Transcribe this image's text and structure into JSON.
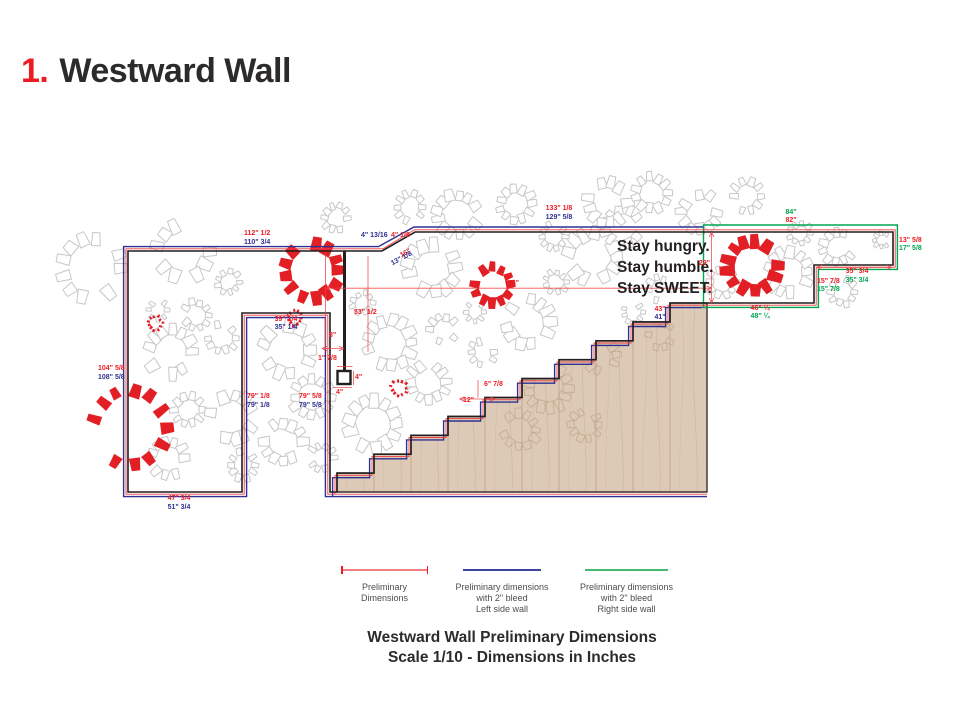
{
  "title": {
    "number": "1.",
    "text": "Westward Wall"
  },
  "quote": {
    "lines": [
      "Stay hungry.",
      "Stay humble.",
      "Stay SWEET."
    ]
  },
  "colors": {
    "red": "#ed1c24",
    "blue": "#2e3192",
    "green": "#00a551",
    "black": "#231f20",
    "legend_red_line": "#f0807f",
    "legend_blue_line": "#3d44a0",
    "legend_green_line": "#45b96f",
    "wood": "#dccab7"
  },
  "dimension_labels": [
    {
      "text": "112\" 1/2",
      "color": "red",
      "x": 244,
      "y": 230,
      "align": "left"
    },
    {
      "text": "110\" 3/4",
      "color": "blue",
      "x": 244,
      "y": 238.5,
      "align": "left"
    },
    {
      "text": "104\" 5/8",
      "color": "red",
      "x": 98,
      "y": 365,
      "align": "left"
    },
    {
      "text": "108\" 5/8",
      "color": "blue",
      "x": 98,
      "y": 373.5,
      "align": "left"
    },
    {
      "text": "47\" 3/4",
      "color": "red",
      "x": 179,
      "y": 495,
      "align": "center"
    },
    {
      "text": "51\" 3/4",
      "color": "blue",
      "x": 179,
      "y": 503.5,
      "align": "center"
    },
    {
      "text": "39\" 1/4",
      "color": "red",
      "x": 286,
      "y": 315.5,
      "align": "center"
    },
    {
      "text": "35\" 1/4",
      "color": "blue",
      "x": 286,
      "y": 324,
      "align": "center"
    },
    {
      "text": "79\" 1/8",
      "color": "red",
      "x": 247,
      "y": 393,
      "align": "left"
    },
    {
      "text": "79\" 1/8",
      "color": "blue",
      "x": 247,
      "y": 401.5,
      "align": "left"
    },
    {
      "text": "79\" 5/8",
      "color": "red",
      "x": 299,
      "y": 393,
      "align": "left"
    },
    {
      "text": "79\" 5/8",
      "color": "blue",
      "x": 299,
      "y": 401.5,
      "align": "left"
    },
    {
      "text": "8\"",
      "color": "red",
      "x": 329,
      "y": 332,
      "align": "left"
    },
    {
      "text": "53\" 1/2",
      "color": "red",
      "x": 354,
      "y": 309,
      "align": "left"
    },
    {
      "text": "4\" 13/16",
      "color": "blue",
      "x": 361,
      "y": 232,
      "align": "left"
    },
    {
      "text": "4\" 1/8",
      "color": "red",
      "x": 391,
      "y": 232,
      "align": "left"
    },
    {
      "text": "16\"",
      "color": "red",
      "x": 399,
      "y": 253,
      "align": "left",
      "rotate": -28
    },
    {
      "text": "13\" 1/8",
      "color": "blue",
      "x": 390,
      "y": 261,
      "align": "left",
      "rotate": -28
    },
    {
      "text": "133\" 1/8",
      "color": "red",
      "x": 559,
      "y": 205,
      "align": "center"
    },
    {
      "text": "129\" 5/8",
      "color": "blue",
      "x": 559,
      "y": 213.5,
      "align": "center"
    },
    {
      "text": "1\" 7/8",
      "color": "red",
      "x": 318,
      "y": 355,
      "align": "left"
    },
    {
      "text": "4\"",
      "color": "red",
      "x": 355,
      "y": 374,
      "align": "left"
    },
    {
      "text": "4\"",
      "color": "red",
      "x": 336,
      "y": 388.5,
      "align": "left"
    },
    {
      "text": "66\"",
      "color": "red",
      "x": 508,
      "y": 279.5,
      "align": "left"
    },
    {
      "text": "6\" 7/8",
      "color": "red",
      "x": 484,
      "y": 381,
      "align": "left"
    },
    {
      "text": "12\"",
      "color": "red",
      "x": 463,
      "y": 397,
      "align": "left"
    },
    {
      "text": "43\"",
      "color": "red",
      "x": 660,
      "y": 305.5,
      "align": "center"
    },
    {
      "text": "41\"",
      "color": "blue",
      "x": 660,
      "y": 314,
      "align": "center"
    },
    {
      "text": "84\"",
      "color": "green",
      "x": 791,
      "y": 208.5,
      "align": "center"
    },
    {
      "text": "82\"",
      "color": "red",
      "x": 791,
      "y": 217,
      "align": "center"
    },
    {
      "text": "29\"",
      "color": "red",
      "x": 710,
      "y": 259.5,
      "align": "right"
    },
    {
      "text": "13\" 5/8",
      "color": "red",
      "x": 899,
      "y": 236.5,
      "align": "left"
    },
    {
      "text": "17\" 5/8",
      "color": "green",
      "x": 899,
      "y": 245,
      "align": "left"
    },
    {
      "text": "35\" 3/4",
      "color": "red",
      "x": 857,
      "y": 268,
      "align": "center"
    },
    {
      "text": "35\" 3/4",
      "color": "green",
      "x": 857,
      "y": 276.5,
      "align": "center"
    },
    {
      "text": "15\" 7/8",
      "color": "red",
      "x": 817,
      "y": 277.5,
      "align": "left"
    },
    {
      "text": "15\" 7/8",
      "color": "green",
      "x": 817,
      "y": 286,
      "align": "left"
    },
    {
      "text": "46\" ¼",
      "color": "red",
      "x": 760,
      "y": 304.5,
      "align": "center"
    },
    {
      "text": "48\" ¼",
      "color": "green",
      "x": 760,
      "y": 313,
      "align": "center"
    }
  ],
  "legend": {
    "items": [
      {
        "line_color_key": "legend_red_line",
        "ticked": true,
        "label_lines": [
          "Preliminary",
          "Dimensions"
        ]
      },
      {
        "line_color_key": "legend_blue_line",
        "ticked": false,
        "label_lines": [
          "Preliminary dimensions",
          "with 2\" bleed",
          "Left side wall"
        ]
      },
      {
        "line_color_key": "legend_green_line",
        "ticked": false,
        "label_lines": [
          "Preliminary dimensions",
          "with 2\" bleed",
          "Right side wall"
        ]
      }
    ]
  },
  "caption": {
    "line1": "Westward Wall Preliminary Dimensions",
    "line2": "Scale 1/10 - Dimensions in Inches"
  }
}
